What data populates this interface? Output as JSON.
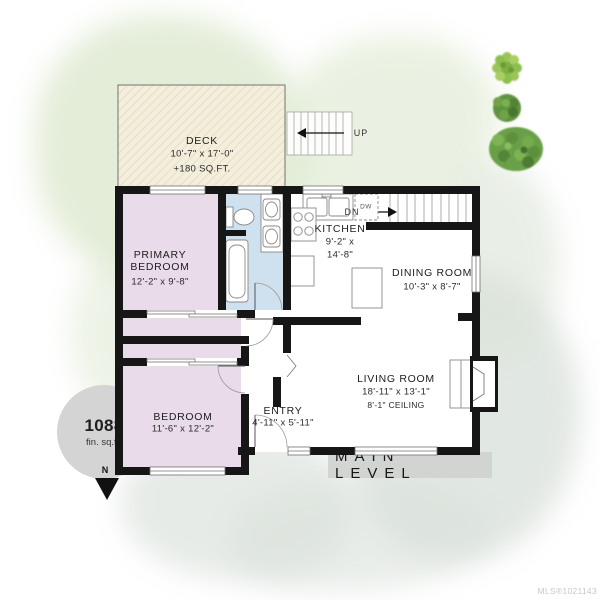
{
  "title": {
    "level_label": "MAIN LEVEL",
    "mls": "MLS®1021143"
  },
  "area_badge": {
    "value": "1088",
    "unit": "fin. sq.ft."
  },
  "compass": {
    "north_label": "N"
  },
  "rooms": {
    "deck": {
      "name": "DECK",
      "dims": "10'-7\" x 17'-0\"",
      "area": "+180 SQ.FT."
    },
    "primary_bedroom": {
      "name": "PRIMARY BEDROOM",
      "dims": "12'-2\" x 9'-8\""
    },
    "kitchen": {
      "name": "KITCHEN",
      "dims_line1": "9'-2\" x",
      "dims_line2": "14'-8\""
    },
    "dining_room": {
      "name": "DINING ROOM",
      "dims": "10'-3\" x 8'-7\""
    },
    "living_room": {
      "name": "LIVING ROOM",
      "dims": "18'-11\" x 13'-1\"",
      "ceiling": "8'-1\" CEILING"
    },
    "bedroom": {
      "name": "BEDROOM",
      "dims": "11'-6\" x 12'-2\""
    },
    "entry": {
      "name": "ENTRY",
      "dims": "4'-11\" x 5'-11\""
    }
  },
  "stairs": {
    "up_label": "UP",
    "down_label": "DN"
  },
  "appliances": {
    "dishwasher_label": "DW"
  },
  "colors": {
    "wall": "#161616",
    "bedroom_fill": "#e9dbe9",
    "bath_fill": "#cfe0ee",
    "deck_fill": "#f4eedd",
    "tree_green": "#6fa34a",
    "badge_gray": "#d0d0d0"
  }
}
